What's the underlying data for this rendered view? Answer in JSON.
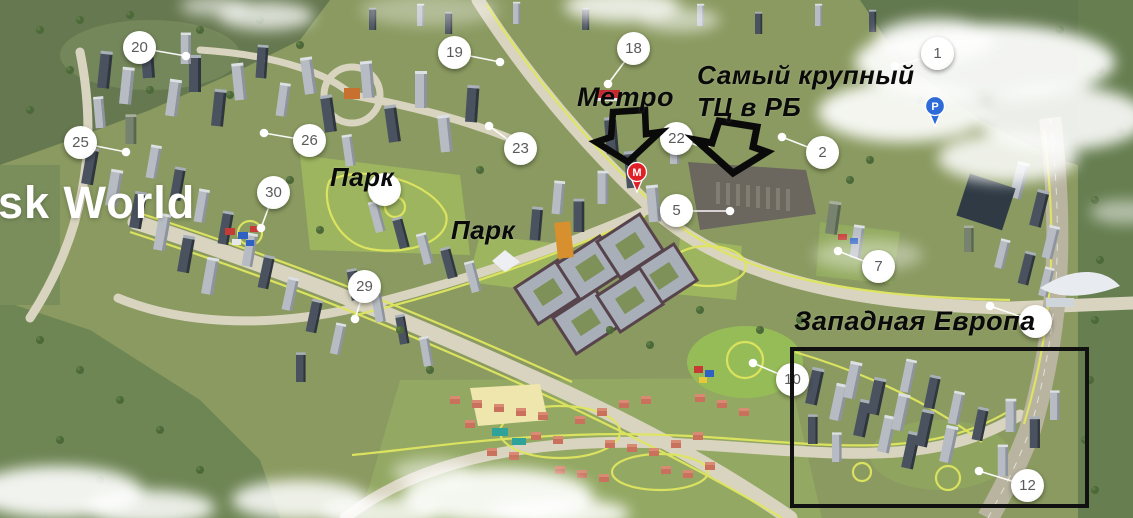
{
  "map": {
    "brand_text": "sk World",
    "colors": {
      "annotation": "#0A0A0A",
      "marker_circle": "#FFFFFF",
      "marker_number": "#5A5A5A",
      "leader_line": "#FFFFFF",
      "metro_pin": "#E01F26",
      "parking_pin": "#2E6BD8",
      "highlight_box": "#111111",
      "brand": "#FFFFFF"
    },
    "brand": {
      "x": -2,
      "y": 180,
      "size": 45
    },
    "labels": [
      {
        "id": "metro",
        "text": "Метро",
        "x": 577,
        "y": 84,
        "size": 27
      },
      {
        "id": "mall-line1",
        "text": "Самый крупный",
        "x": 697,
        "y": 62,
        "size": 26
      },
      {
        "id": "mall-line2",
        "text": "ТЦ в РБ",
        "x": 697,
        "y": 94,
        "size": 26
      },
      {
        "id": "park-1",
        "text": "Парк",
        "x": 330,
        "y": 164,
        "size": 26
      },
      {
        "id": "park-2",
        "text": "Парк",
        "x": 451,
        "y": 217,
        "size": 26
      },
      {
        "id": "west-europe",
        "text": "Западная Европа",
        "x": 794,
        "y": 308,
        "size": 27
      }
    ],
    "markers": [
      {
        "n": "20",
        "x": 140,
        "y": 48,
        "dot": [
          186,
          56
        ]
      },
      {
        "n": "19",
        "x": 455,
        "y": 53,
        "dot": [
          500,
          62
        ]
      },
      {
        "n": "18",
        "x": 634,
        "y": 49,
        "dot": [
          608,
          84
        ]
      },
      {
        "n": "1",
        "x": 938,
        "y": 54,
        "dot": [
          895,
          66
        ]
      },
      {
        "n": "25",
        "x": 81,
        "y": 143,
        "dot": [
          126,
          152
        ]
      },
      {
        "n": "26",
        "x": 310,
        "y": 141,
        "dot": [
          264,
          133
        ]
      },
      {
        "n": "23",
        "x": 521,
        "y": 149,
        "dot": [
          489,
          126
        ]
      },
      {
        "n": "22",
        "x": 677,
        "y": 139,
        "dot": [
          706,
          148
        ]
      },
      {
        "n": "2",
        "x": 823,
        "y": 153,
        "dot": [
          782,
          137
        ]
      },
      {
        "n": "30",
        "x": 274,
        "y": 193,
        "dot": [
          261,
          228
        ]
      },
      {
        "n": "5",
        "x": 677,
        "y": 211,
        "dot": [
          730,
          211
        ]
      },
      {
        "n": "7",
        "x": 879,
        "y": 267,
        "dot": [
          838,
          251
        ]
      },
      {
        "n": "29",
        "x": 365,
        "y": 287,
        "dot": [
          355,
          319
        ]
      },
      {
        "n": "10",
        "x": 793,
        "y": 380,
        "dot": [
          753,
          363
        ]
      },
      {
        "n": "12",
        "x": 1028,
        "y": 486,
        "dot": [
          979,
          471
        ]
      },
      {
        "n": "",
        "x": 385,
        "y": 190,
        "dot": null
      },
      {
        "n": "",
        "x": 1036,
        "y": 322,
        "dot": [
          990,
          306
        ]
      }
    ],
    "pins": [
      {
        "type": "metro",
        "letter": "М",
        "color": "#E01F26",
        "x": 637,
        "y": 172
      },
      {
        "type": "parking",
        "letter": "P",
        "color": "#2E6BD8",
        "x": 935,
        "y": 106
      }
    ],
    "highlight_box": {
      "x": 792,
      "y": 349,
      "w": 295,
      "h": 157
    }
  }
}
